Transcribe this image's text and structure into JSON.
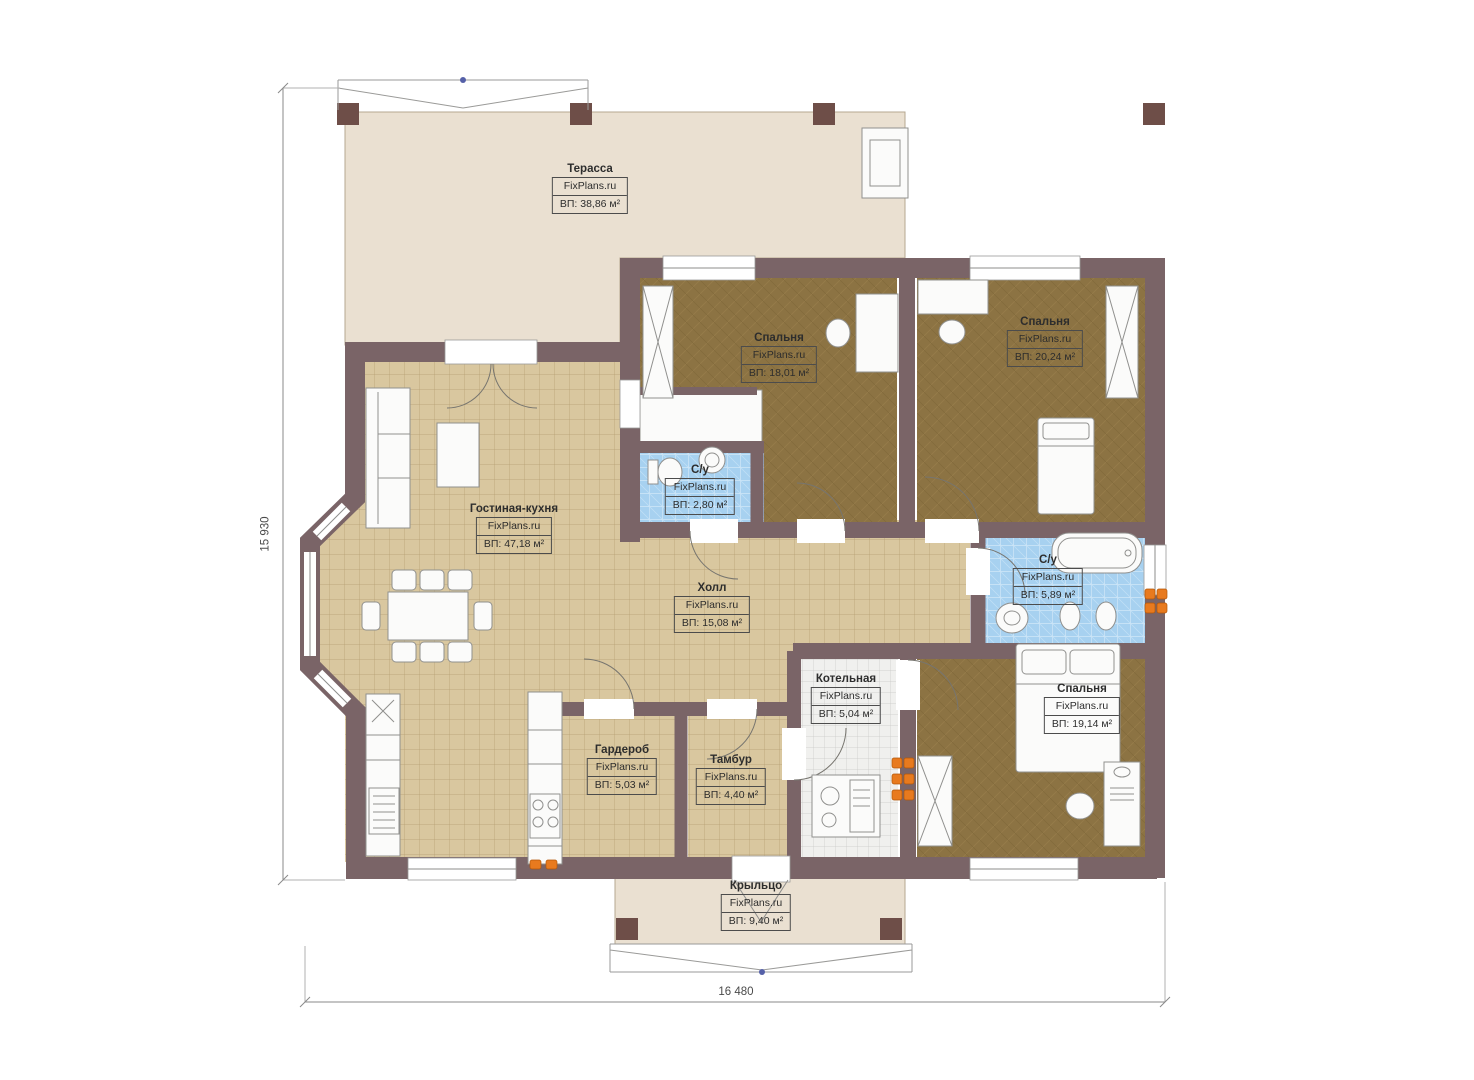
{
  "meta": {
    "brand": "FixPlans.ru",
    "plan_type": "floor-plan"
  },
  "rooms": [
    {
      "name": "Терасса",
      "brand": "FixPlans.ru",
      "area": "ВП: 38,86 м²"
    },
    {
      "name": "Спальня",
      "brand": "FixPlans.ru",
      "area": "ВП: 18,01 м²"
    },
    {
      "name": "Спальня",
      "brand": "FixPlans.ru",
      "area": "ВП: 20,24 м²"
    },
    {
      "name": "С/у",
      "brand": "FixPlans.ru",
      "area": "ВП: 2,80 м²"
    },
    {
      "name": "Гостиная-кухня",
      "brand": "FixPlans.ru",
      "area": "ВП: 47,18 м²"
    },
    {
      "name": "Холл",
      "brand": "FixPlans.ru",
      "area": "ВП: 15,08 м²"
    },
    {
      "name": "С/у",
      "brand": "FixPlans.ru",
      "area": "ВП: 5,89 м²"
    },
    {
      "name": "Котельная",
      "brand": "FixPlans.ru",
      "area": "ВП: 5,04 м²"
    },
    {
      "name": "Спальня",
      "brand": "FixPlans.ru",
      "area": "ВП: 19,14 м²"
    },
    {
      "name": "Гардероб",
      "brand": "FixPlans.ru",
      "area": "ВП: 5,03 м²"
    },
    {
      "name": "Тамбур",
      "brand": "FixPlans.ru",
      "area": "ВП: 4,40 м²"
    },
    {
      "name": "Крыльцо",
      "brand": "FixPlans.ru",
      "area": "ВП: 9,40 м²"
    }
  ],
  "dimensions": {
    "height_mm": "15 930",
    "width_mm": "16 480"
  },
  "colors": {
    "wall": "#7a6467",
    "post": "#6e4e48",
    "terrace_floor": "#eae0d1",
    "tile_floor": "#d9c79f",
    "bedroom_floor": "#8c7343",
    "bath_tile": "#a7d1f0",
    "boiler_tile": "#f0f0ee",
    "radiator": "#e87a1e"
  }
}
